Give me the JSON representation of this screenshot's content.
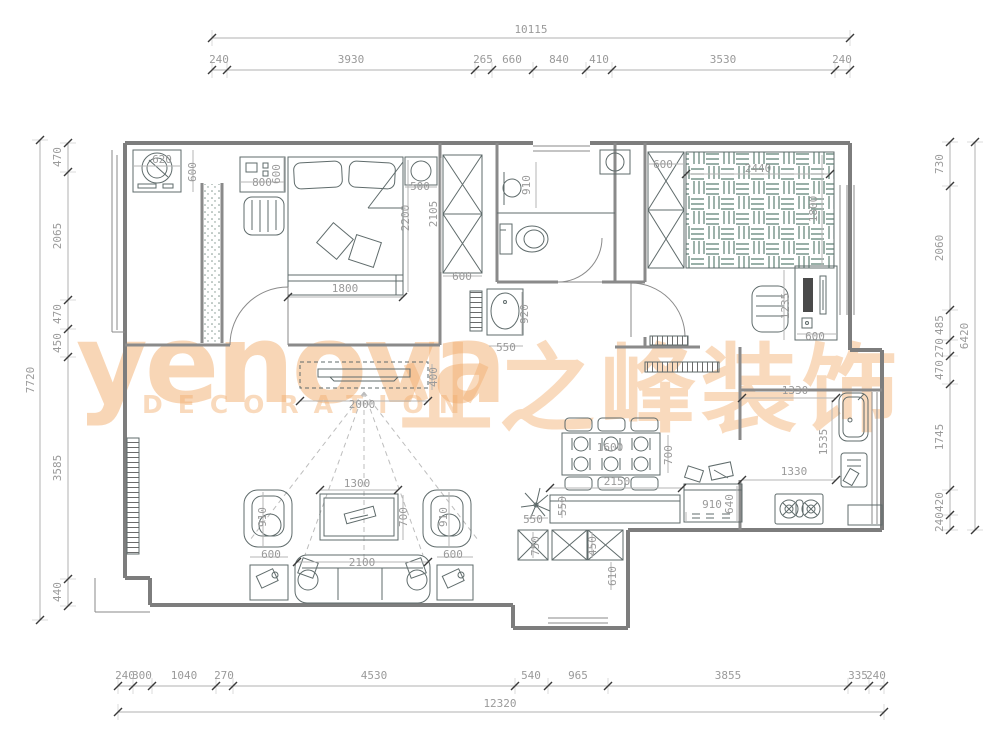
{
  "watermark": {
    "brand": "yenova",
    "sub": "DECORATION",
    "cn": "业之峰装饰",
    "color": "#F2AE6F"
  },
  "chains": [
    {
      "dir": "h",
      "y": 38,
      "from": 212,
      "to": 850,
      "ticks": [
        212,
        850
      ],
      "labels": [
        {
          "t": "10115",
          "x": 531,
          "y": 33
        }
      ]
    },
    {
      "dir": "h",
      "y": 70,
      "from": 212,
      "to": 850,
      "ticks": [
        212,
        227,
        475,
        492,
        533,
        586,
        612,
        835,
        850
      ],
      "labels": [
        {
          "t": "240",
          "x": 219,
          "y": 63
        },
        {
          "t": "3930",
          "x": 351,
          "y": 63
        },
        {
          "t": "265",
          "x": 483,
          "y": 63
        },
        {
          "t": "660",
          "x": 512,
          "y": 63
        },
        {
          "t": "840",
          "x": 559,
          "y": 63
        },
        {
          "t": "410",
          "x": 599,
          "y": 63
        },
        {
          "t": "3530",
          "x": 723,
          "y": 63
        },
        {
          "t": "240",
          "x": 842,
          "y": 63
        }
      ]
    },
    {
      "dir": "v",
      "x": 40,
      "from": 140,
      "to": 620,
      "ticks": [
        140,
        620
      ],
      "labels": [
        {
          "t": "7720",
          "x": 34,
          "y": 380,
          "r": -90
        }
      ]
    },
    {
      "dir": "v",
      "x": 68,
      "from": 143,
      "to": 606,
      "ticks": [
        143,
        172,
        300,
        329,
        357,
        579,
        606
      ],
      "labels": [
        {
          "t": "470",
          "x": 61,
          "y": 157,
          "r": -90
        },
        {
          "t": "2065",
          "x": 61,
          "y": 236,
          "r": -90
        },
        {
          "t": "470",
          "x": 61,
          "y": 314,
          "r": -90
        },
        {
          "t": "450",
          "x": 61,
          "y": 343,
          "r": -90
        },
        {
          "t": "3585",
          "x": 61,
          "y": 468,
          "r": -90
        },
        {
          "t": "440",
          "x": 61,
          "y": 592,
          "r": -90
        }
      ]
    },
    {
      "dir": "v",
      "x": 975,
      "from": 142,
      "to": 530,
      "ticks": [
        142,
        530
      ],
      "labels": [
        {
          "t": "6420",
          "x": 968,
          "y": 336,
          "r": -90
        }
      ]
    },
    {
      "dir": "v",
      "x": 950,
      "from": 142,
      "to": 530,
      "ticks": [
        142,
        186,
        310,
        340,
        356,
        384,
        490,
        515,
        530
      ],
      "labels": [
        {
          "t": "730",
          "x": 943,
          "y": 164,
          "r": -90
        },
        {
          "t": "2060",
          "x": 943,
          "y": 248,
          "r": -90
        },
        {
          "t": "485",
          "x": 943,
          "y": 325,
          "r": -90
        },
        {
          "t": "270",
          "x": 943,
          "y": 348,
          "r": -90
        },
        {
          "t": "470",
          "x": 943,
          "y": 370,
          "r": -90
        },
        {
          "t": "1745",
          "x": 943,
          "y": 437,
          "r": -90
        },
        {
          "t": "420",
          "x": 943,
          "y": 502,
          "r": -90
        },
        {
          "t": "240",
          "x": 943,
          "y": 522,
          "r": -90
        }
      ]
    },
    {
      "dir": "h",
      "y": 686,
      "from": 118,
      "to": 884,
      "ticks": [
        118,
        133,
        152,
        216,
        233,
        515,
        548,
        608,
        848,
        869,
        884
      ],
      "labels": [
        {
          "t": "240",
          "x": 125,
          "y": 679
        },
        {
          "t": "300",
          "x": 142,
          "y": 679
        },
        {
          "t": "1040",
          "x": 184,
          "y": 679
        },
        {
          "t": "270",
          "x": 224,
          "y": 679
        },
        {
          "t": "4530",
          "x": 374,
          "y": 679
        },
        {
          "t": "540",
          "x": 531,
          "y": 679
        },
        {
          "t": "965",
          "x": 578,
          "y": 679
        },
        {
          "t": "3855",
          "x": 728,
          "y": 679
        },
        {
          "t": "335",
          "x": 858,
          "y": 679
        },
        {
          "t": "240",
          "x": 876,
          "y": 679
        }
      ]
    },
    {
      "dir": "h",
      "y": 712,
      "from": 118,
      "to": 884,
      "ticks": [
        118,
        884
      ],
      "labels": [
        {
          "t": "12320",
          "x": 500,
          "y": 707
        }
      ]
    }
  ],
  "interior_labels": [
    {
      "t": "620",
      "x": 162,
      "y": 163
    },
    {
      "t": "600",
      "x": 196,
      "y": 172,
      "r": -90
    },
    {
      "t": "800",
      "x": 262,
      "y": 186
    },
    {
      "t": "600",
      "x": 280,
      "y": 174,
      "r": -90
    },
    {
      "t": "1800",
      "x": 345,
      "y": 292
    },
    {
      "t": "2200",
      "x": 409,
      "y": 218,
      "r": -90
    },
    {
      "t": "2105",
      "x": 437,
      "y": 214,
      "r": -90
    },
    {
      "t": "500",
      "x": 420,
      "y": 190
    },
    {
      "t": "600",
      "x": 462,
      "y": 280
    },
    {
      "t": "910",
      "x": 530,
      "y": 185,
      "r": -90
    },
    {
      "t": "920",
      "x": 528,
      "y": 314,
      "r": -90
    },
    {
      "t": "550",
      "x": 506,
      "y": 351
    },
    {
      "t": "600",
      "x": 663,
      "y": 168
    },
    {
      "t": "2440",
      "x": 758,
      "y": 172
    },
    {
      "t": "1800",
      "x": 817,
      "y": 209,
      "r": -90
    },
    {
      "t": "1235",
      "x": 789,
      "y": 306,
      "r": -90
    },
    {
      "t": "600",
      "x": 815,
      "y": 340
    },
    {
      "t": "400",
      "x": 437,
      "y": 377,
      "r": -90
    },
    {
      "t": "2000",
      "x": 362,
      "y": 408
    },
    {
      "t": "550",
      "x": 566,
      "y": 506,
      "r": -90
    },
    {
      "t": "550",
      "x": 533,
      "y": 523
    },
    {
      "t": "2150",
      "x": 617,
      "y": 485
    },
    {
      "t": "1600",
      "x": 610,
      "y": 451
    },
    {
      "t": "700",
      "x": 672,
      "y": 455,
      "r": -90
    },
    {
      "t": "910",
      "x": 712,
      "y": 508
    },
    {
      "t": "640",
      "x": 733,
      "y": 504,
      "r": -90
    },
    {
      "t": "750",
      "x": 539,
      "y": 546,
      "r": -90
    },
    {
      "t": "450",
      "x": 596,
      "y": 546,
      "r": -90
    },
    {
      "t": "610",
      "x": 616,
      "y": 576,
      "r": -90
    },
    {
      "t": "1330",
      "x": 795,
      "y": 394
    },
    {
      "t": "1535",
      "x": 827,
      "y": 442,
      "r": -90
    },
    {
      "t": "1330",
      "x": 794,
      "y": 475
    },
    {
      "t": "1300",
      "x": 357,
      "y": 487
    },
    {
      "t": "700",
      "x": 407,
      "y": 517,
      "r": -90
    },
    {
      "t": "910",
      "x": 266,
      "y": 517,
      "r": -90
    },
    {
      "t": "910",
      "x": 447,
      "y": 517,
      "r": -90
    },
    {
      "t": "600",
      "x": 271,
      "y": 558
    },
    {
      "t": "600",
      "x": 453,
      "y": 558
    },
    {
      "t": "2100",
      "x": 362,
      "y": 566
    }
  ]
}
